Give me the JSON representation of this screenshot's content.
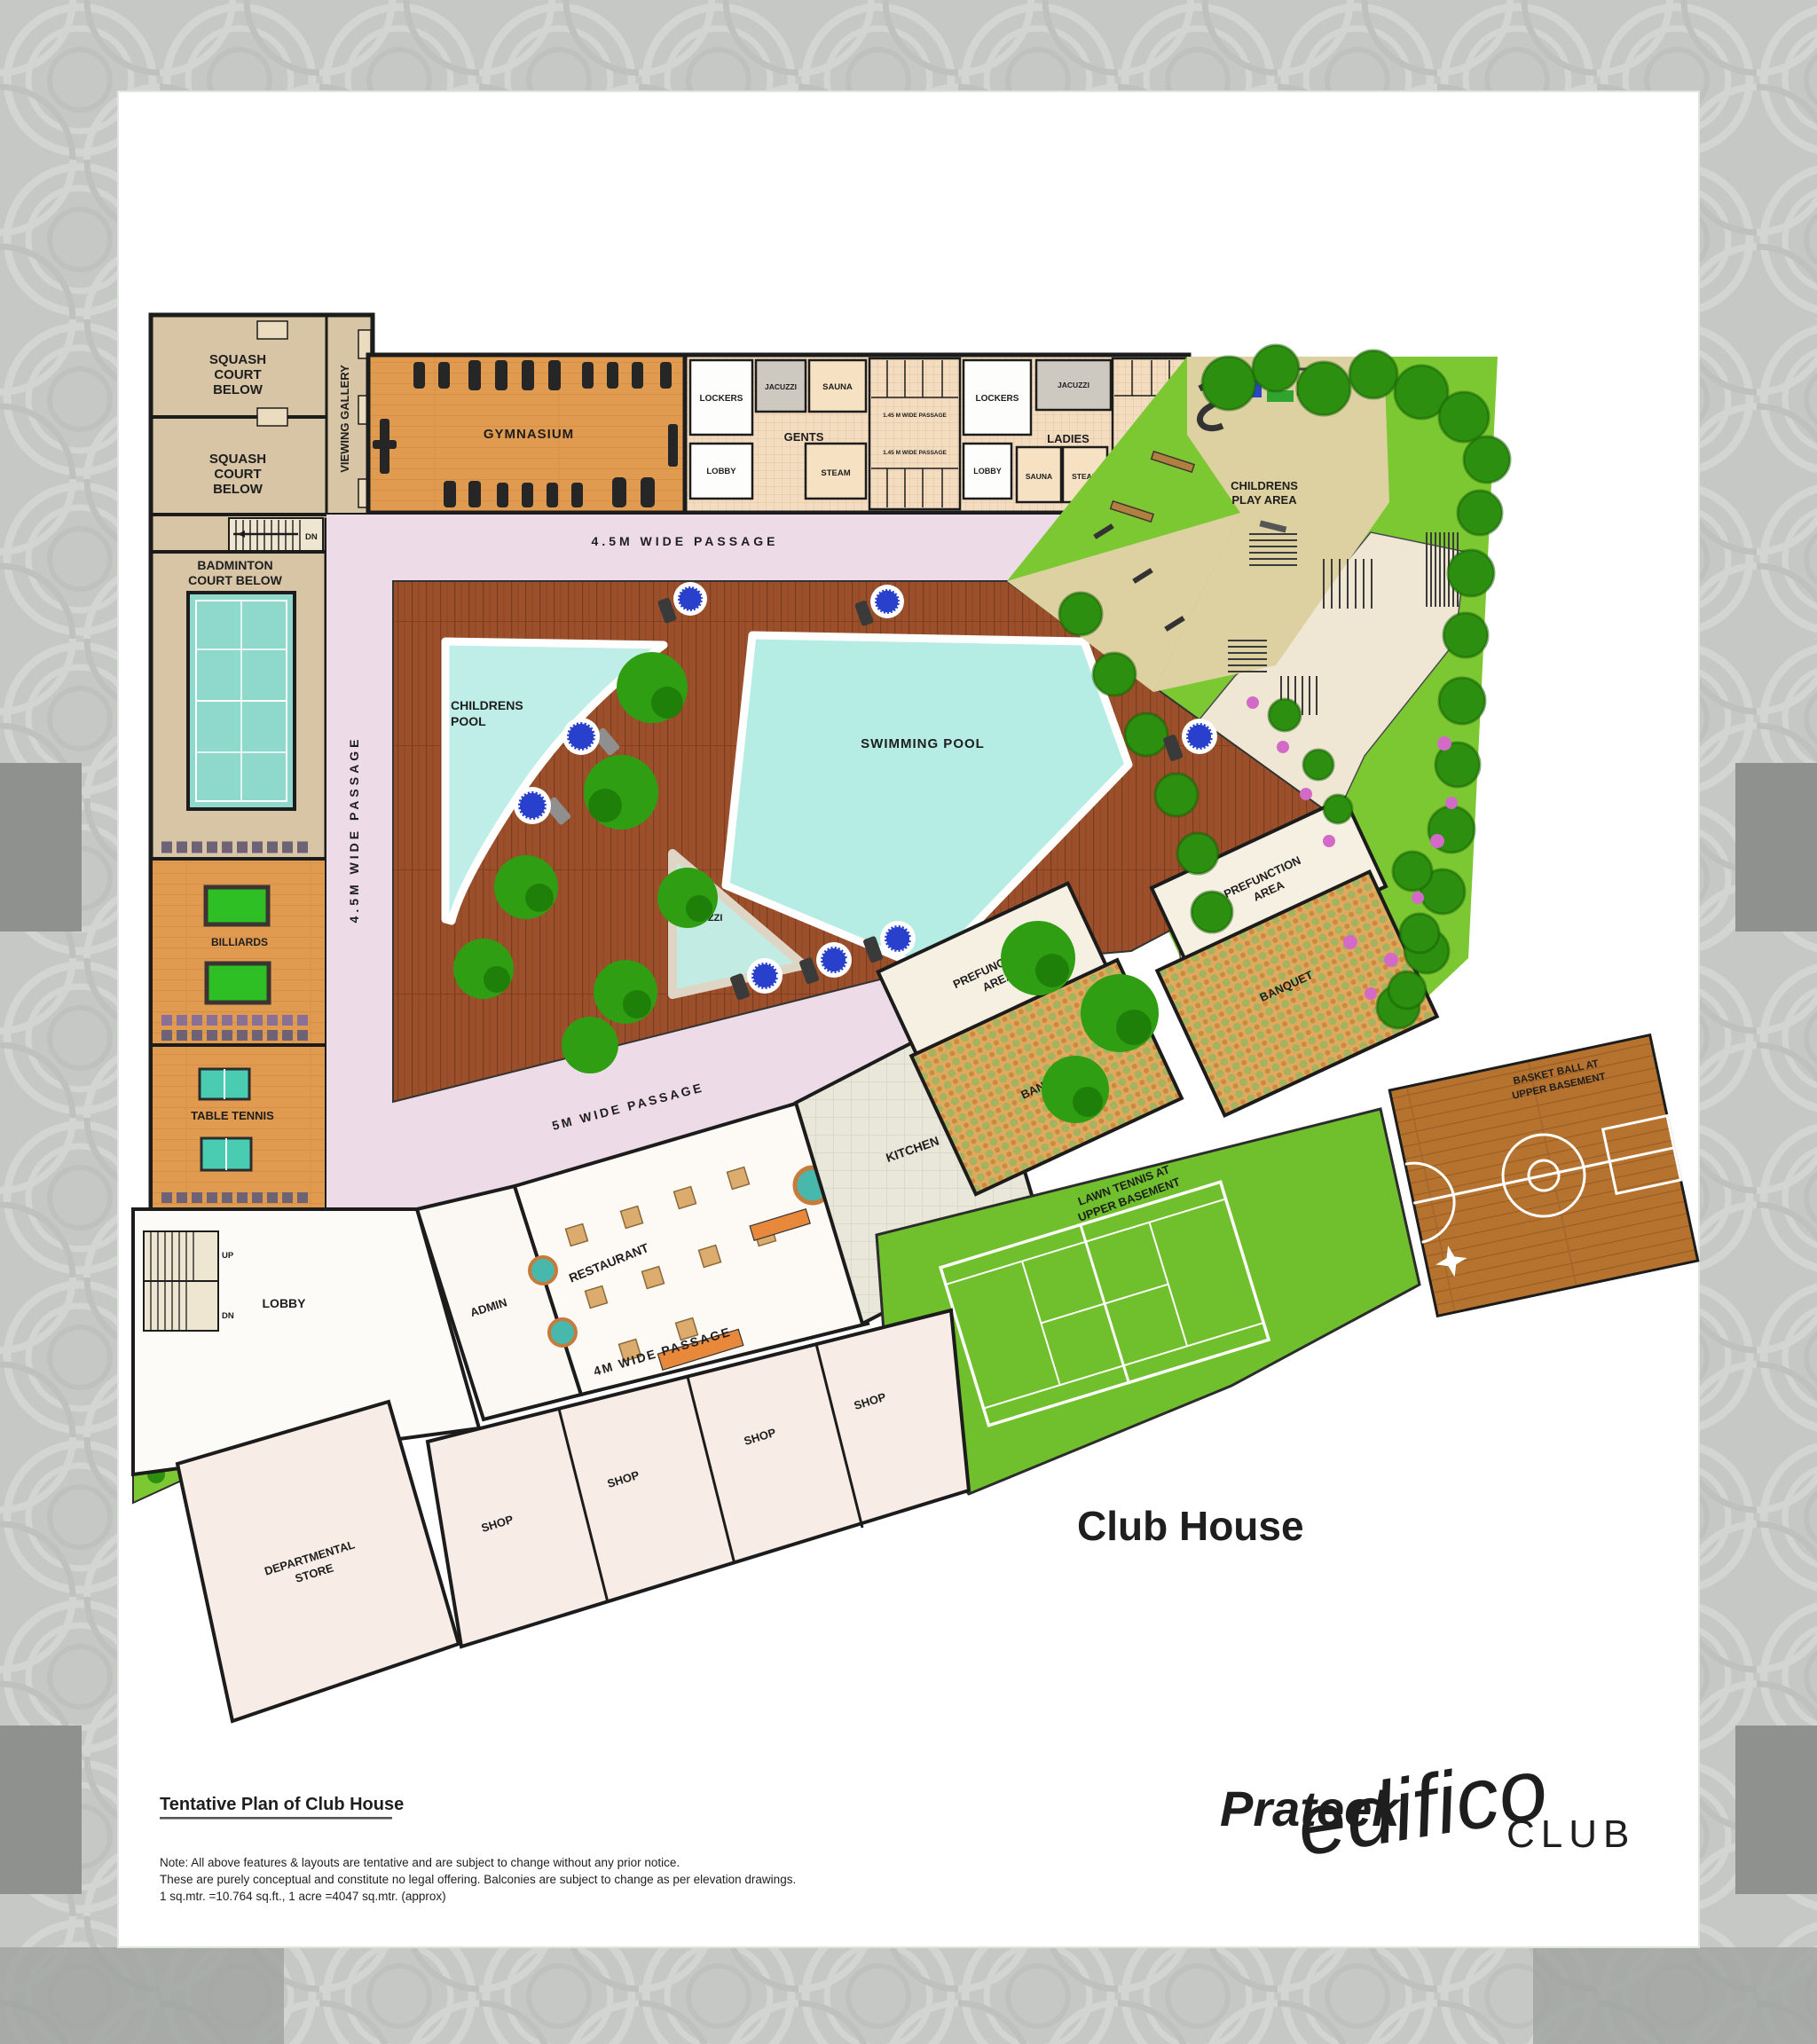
{
  "plan": {
    "left_wing": {
      "squash_court_1": "SQUASH|COURT|BELOW",
      "squash_court_2": "SQUASH|COURT|BELOW",
      "viewing_gallery": "VIEWING GALLERY",
      "stairs_dn": "DN",
      "badminton": "BADMINTON|COURT BELOW",
      "billiards": "BILLIARDS",
      "table_tennis": "TABLE TENNIS"
    },
    "top_wing": {
      "gymnasium": "GYMNASIUM",
      "gents": {
        "lockers": "LOCKERS",
        "jacuzzi": "JACUZZI",
        "sauna": "SAUNA",
        "label": "GENTS",
        "lobby": "LOBBY",
        "steam": "STEAM",
        "passage_top": "1.45 M WIDE PASSAGE",
        "passage_bottom": "1.45 M WIDE PASSAGE"
      },
      "ladies": {
        "lockers": "LOCKERS",
        "lobby": "LOBBY",
        "jacuzzi": "JACUZZI",
        "label": "LADIES",
        "sauna": "SAUNA",
        "steam": "STEAM"
      }
    },
    "outdoor": {
      "childrens_play_area": "CHILDRENS|PLAY AREA",
      "childrens_pool": "CHILDRENS|POOL",
      "swimming_pool": "SWIMMING POOL",
      "jacuzzi": "JACUZZI"
    },
    "passages": {
      "p45_top": "4.5M WIDE PASSAGE",
      "p45_left": "4.5M WIDE PASSAGE",
      "p5": "5M WIDE PASSAGE",
      "p4": "4M WIDE PASSAGE"
    },
    "lower_wing": {
      "lobby": "LOBBY",
      "stairs_up": "UP",
      "stairs_dn": "DN",
      "admin": "ADMIN",
      "restaurant": "RESTAURANT",
      "kitchen": "KITCHEN",
      "prefunction_1": "PREFUNCTION|AREA",
      "banquet_1": "BANQUET",
      "prefunction_2": "PREFUNCTION|AREA",
      "banquet_2": "BANQUET",
      "lawn_tennis": "LAWN TENNIS AT|UPPER BASEMENT",
      "basketball": "BASKET BALL AT|UPPER BASEMENT",
      "shops": [
        "SHOP",
        "SHOP",
        "SHOP",
        "SHOP"
      ],
      "departmental_store": "DEPARTMENTAL|STORE"
    },
    "caption": "Club House"
  },
  "footer": {
    "heading": "Tentative Plan of Club House",
    "note_line1": "Note: All above features & layouts are tentative and are subject to change without any prior notice.",
    "note_line2": "These are purely conceptual and constitute no legal offering. Balconies are subject to change as per elevation drawings.",
    "note_line3": "1 sq.mtr. =10.764 sq.ft., 1 acre =4047 sq.mtr. (approx)"
  },
  "logo": {
    "brand": "Prateek",
    "name": "edifico",
    "suffix": "CLUB"
  },
  "colors": {
    "deck": "#9b502b",
    "pool_water": "#b5ece4",
    "passage_pink": "#eddbe7",
    "lawn": "#7cc832",
    "tennis_green": "#6fc02c",
    "sand": "#ddd0a1",
    "banquet_orange": "#e0a95d",
    "gym_wood": "#e19b51",
    "logo_purple": "#8a17dd",
    "logo_teal": "#35c7a4",
    "logo_blue": "#2a55d8"
  }
}
